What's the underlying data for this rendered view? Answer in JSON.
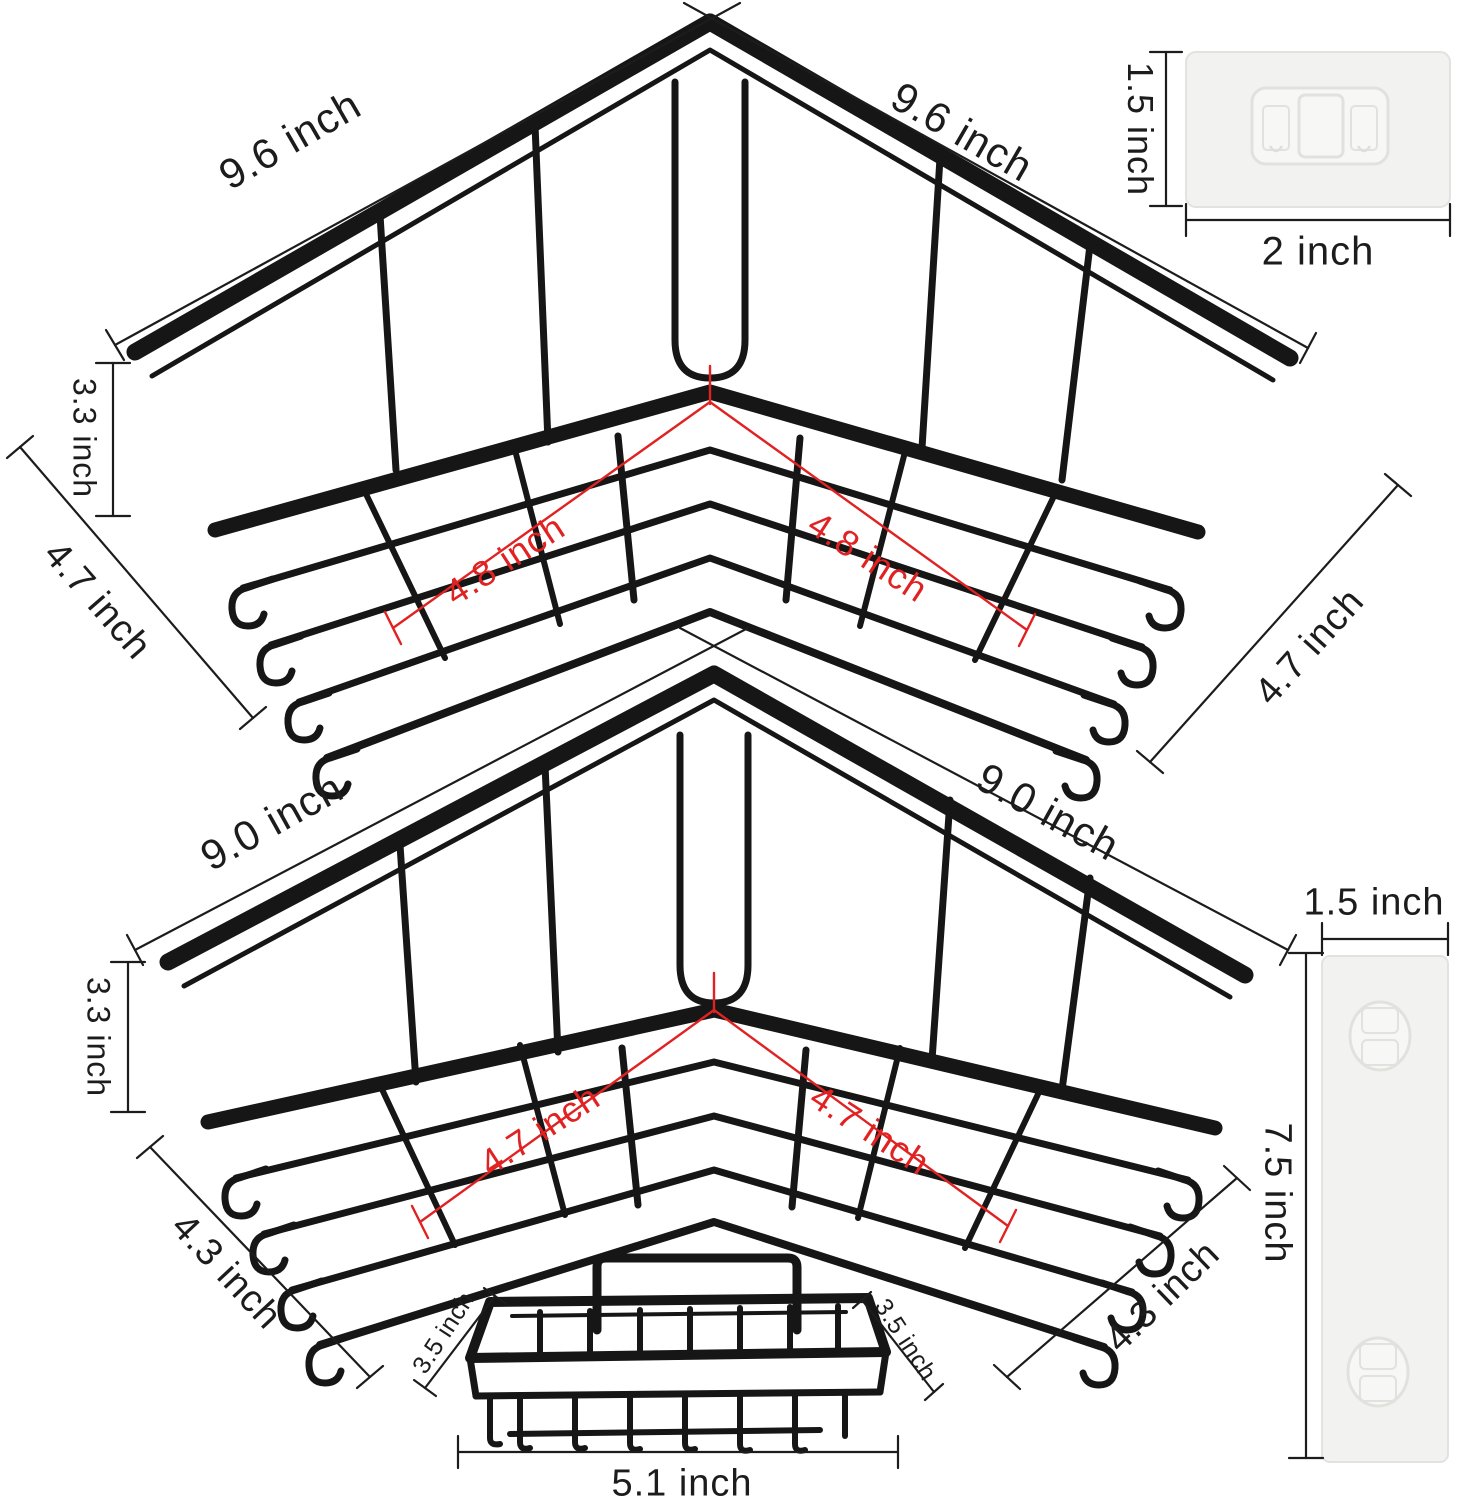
{
  "title": "Corner shower caddy dimension diagram",
  "colors": {
    "wire": "#161616",
    "dimension_line": "#1c1c1c",
    "red_dimension": "#e02222",
    "adhesive_fill": "#f2f2f0",
    "adhesive_stroke": "#e2e2df"
  },
  "products": {
    "large_corner_shelf": {
      "width_left": "9.6 inch",
      "width_right": "9.6 inch",
      "height": "3.3 inch",
      "depth_left": "4.7 inch",
      "depth_right": "4.7 inch",
      "inner_depth_left": "4.8 inch",
      "inner_depth_right": "4.8 inch"
    },
    "small_corner_shelf": {
      "width_left": "9.0 inch",
      "width_right": "9.0 inch",
      "height": "3.3 inch",
      "depth_left": "4.3 inch",
      "depth_right": "4.3 inch",
      "inner_depth_left": "4.7 inch",
      "inner_depth_right": "4.7 inch"
    },
    "adhesive_pad": {
      "height": "1.5 inch",
      "width": "2 inch"
    },
    "adhesive_strip": {
      "width": "1.5 inch",
      "height": "7.5 inch"
    },
    "soap_dish": {
      "side_left": "3.5 inch",
      "side_right": "3.5 inch",
      "width": "5.1 inch"
    }
  }
}
